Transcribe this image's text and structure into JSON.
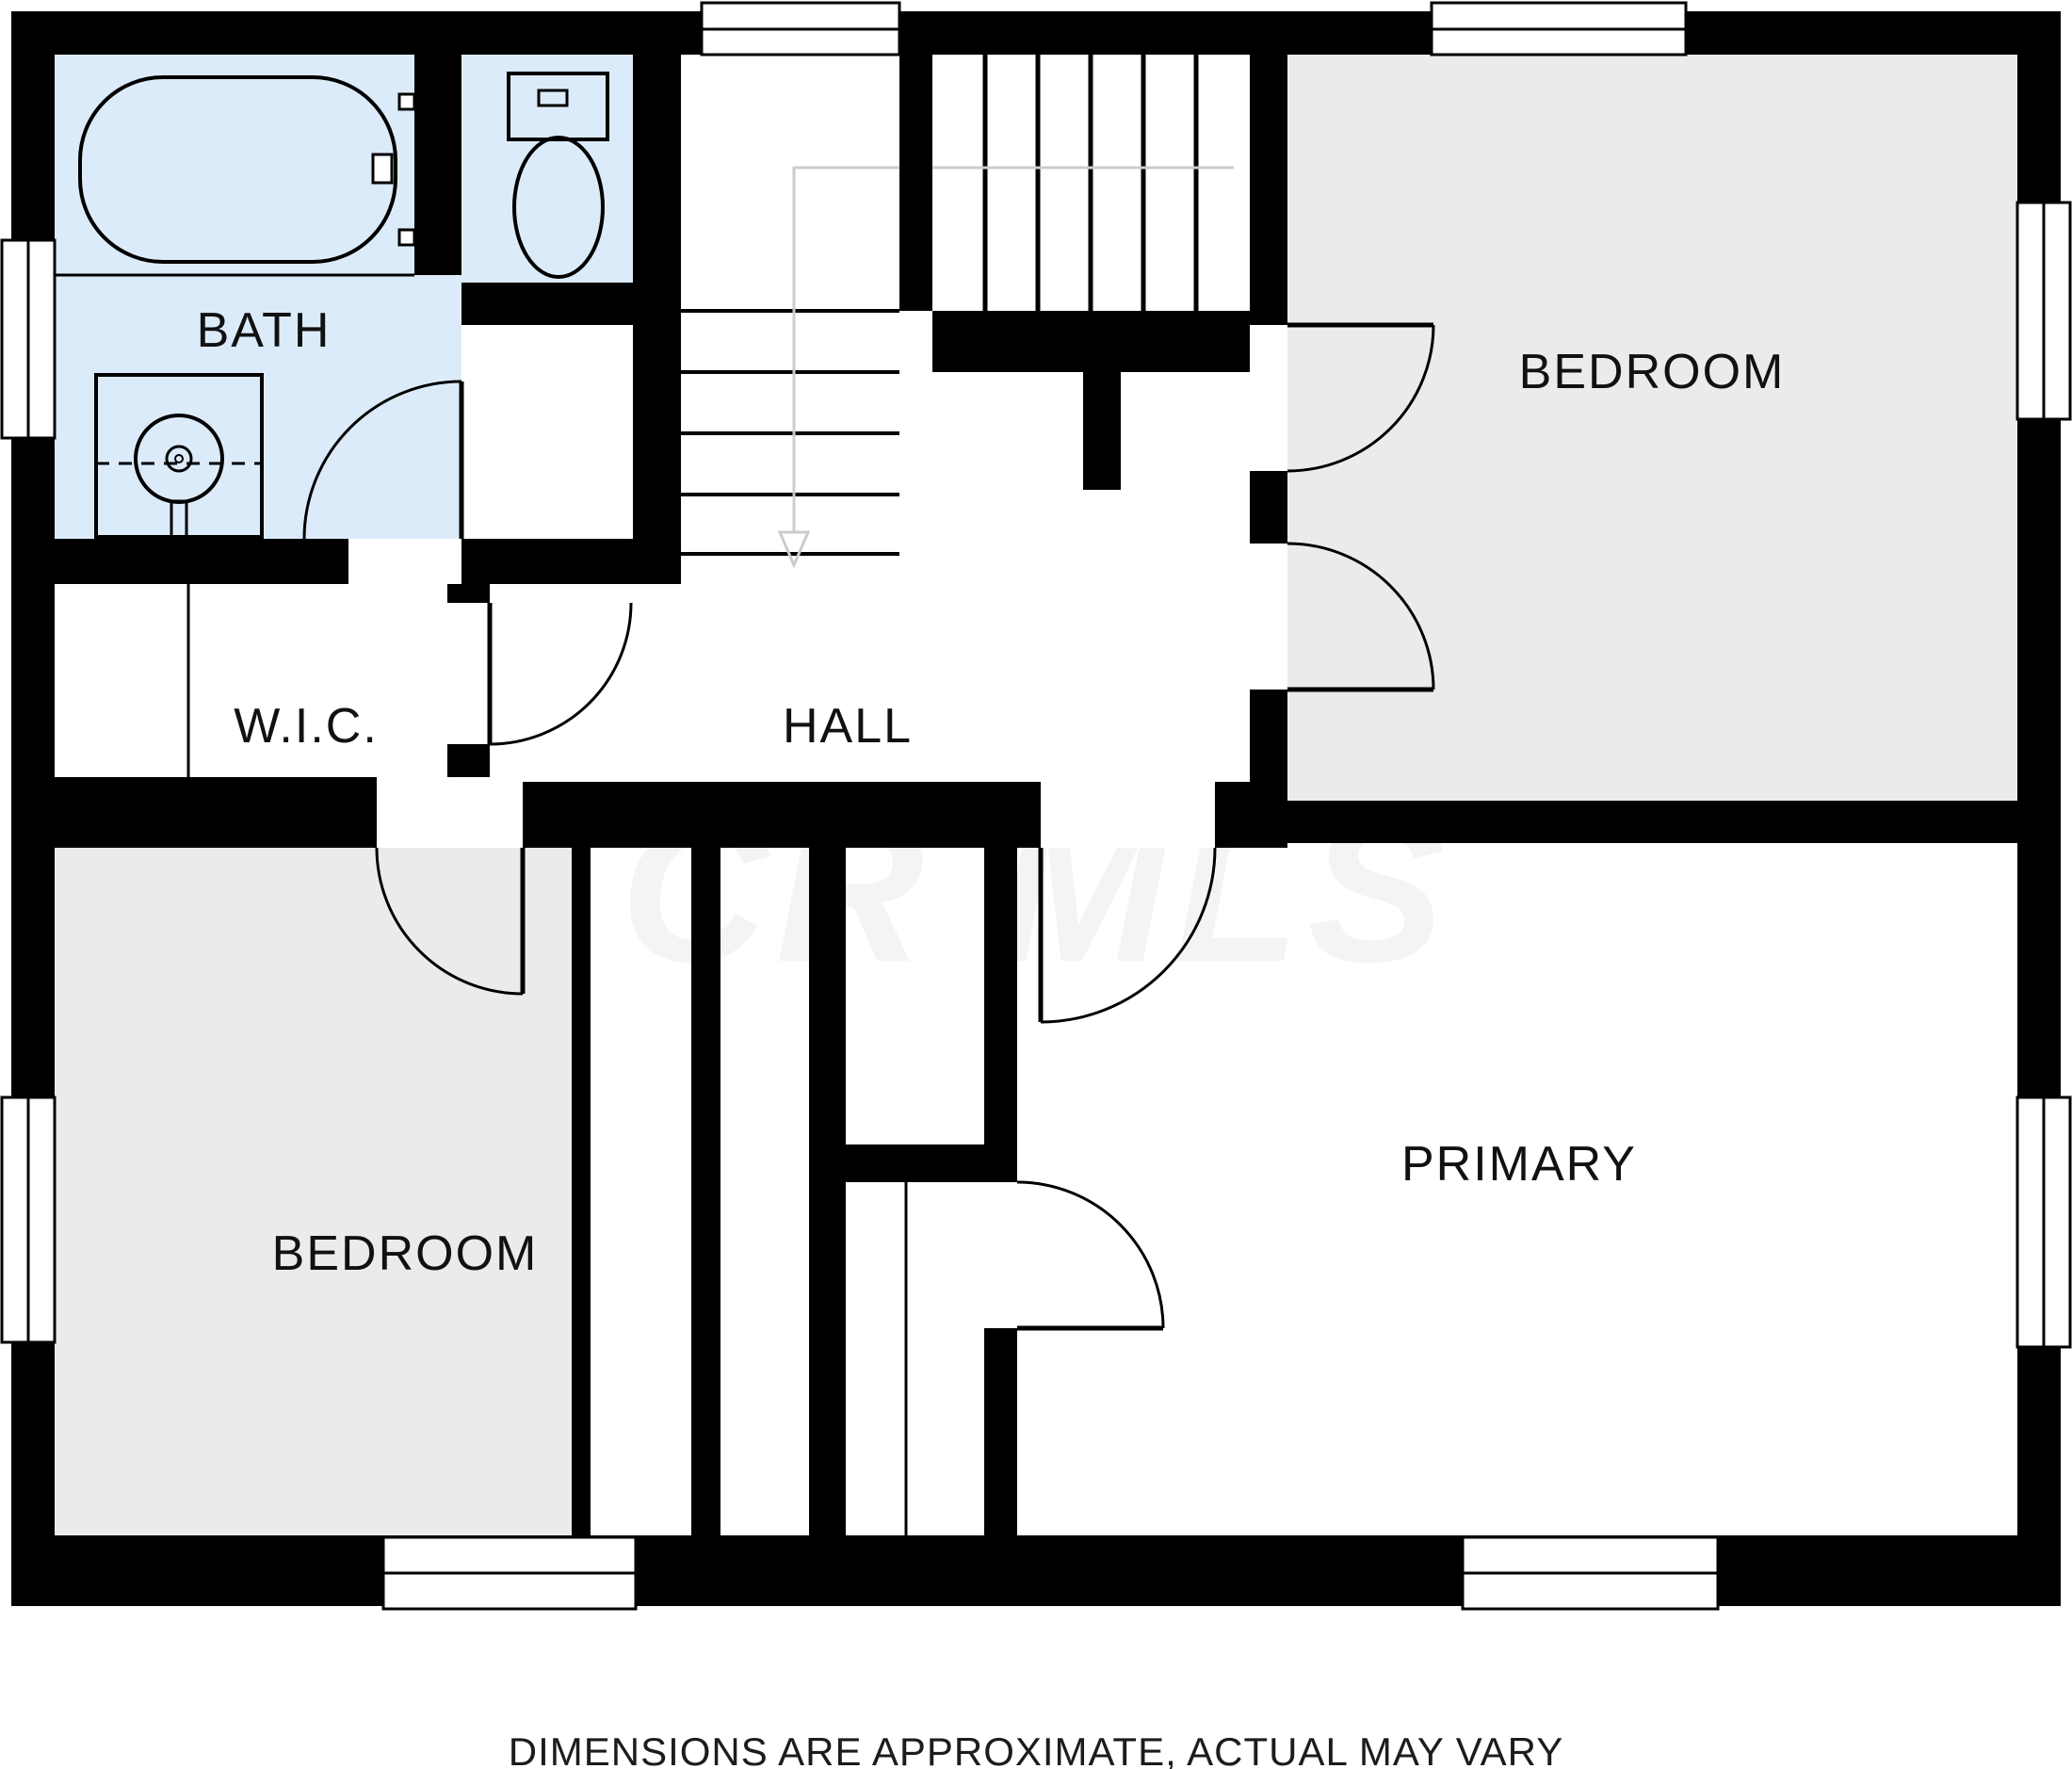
{
  "watermark": {
    "text": "CR MLS",
    "color": "#f4f4f4"
  },
  "caption": {
    "text": "DIMENSIONS ARE APPROXIMATE, ACTUAL MAY VARY",
    "color": "#1c1c1c"
  },
  "colors": {
    "wall": "#000000",
    "bath_floor": "#dcebfa",
    "bedroom_floor": "#ebebeb",
    "white_floor": "#ffffff",
    "stair_guide": "#cccccc",
    "line": "#000000"
  },
  "rooms": [
    {
      "id": "bath",
      "label": "BATH"
    },
    {
      "id": "bedroom-top",
      "label": "BEDROOM"
    },
    {
      "id": "wic",
      "label": "W.I.C."
    },
    {
      "id": "hall",
      "label": "HALL"
    },
    {
      "id": "bedroom-left",
      "label": "BEDROOM"
    },
    {
      "id": "primary",
      "label": "PRIMARY"
    }
  ],
  "fixtures": [
    {
      "name": "bathtub"
    },
    {
      "name": "toilet"
    },
    {
      "name": "sink-vanity"
    },
    {
      "name": "staircase"
    }
  ]
}
